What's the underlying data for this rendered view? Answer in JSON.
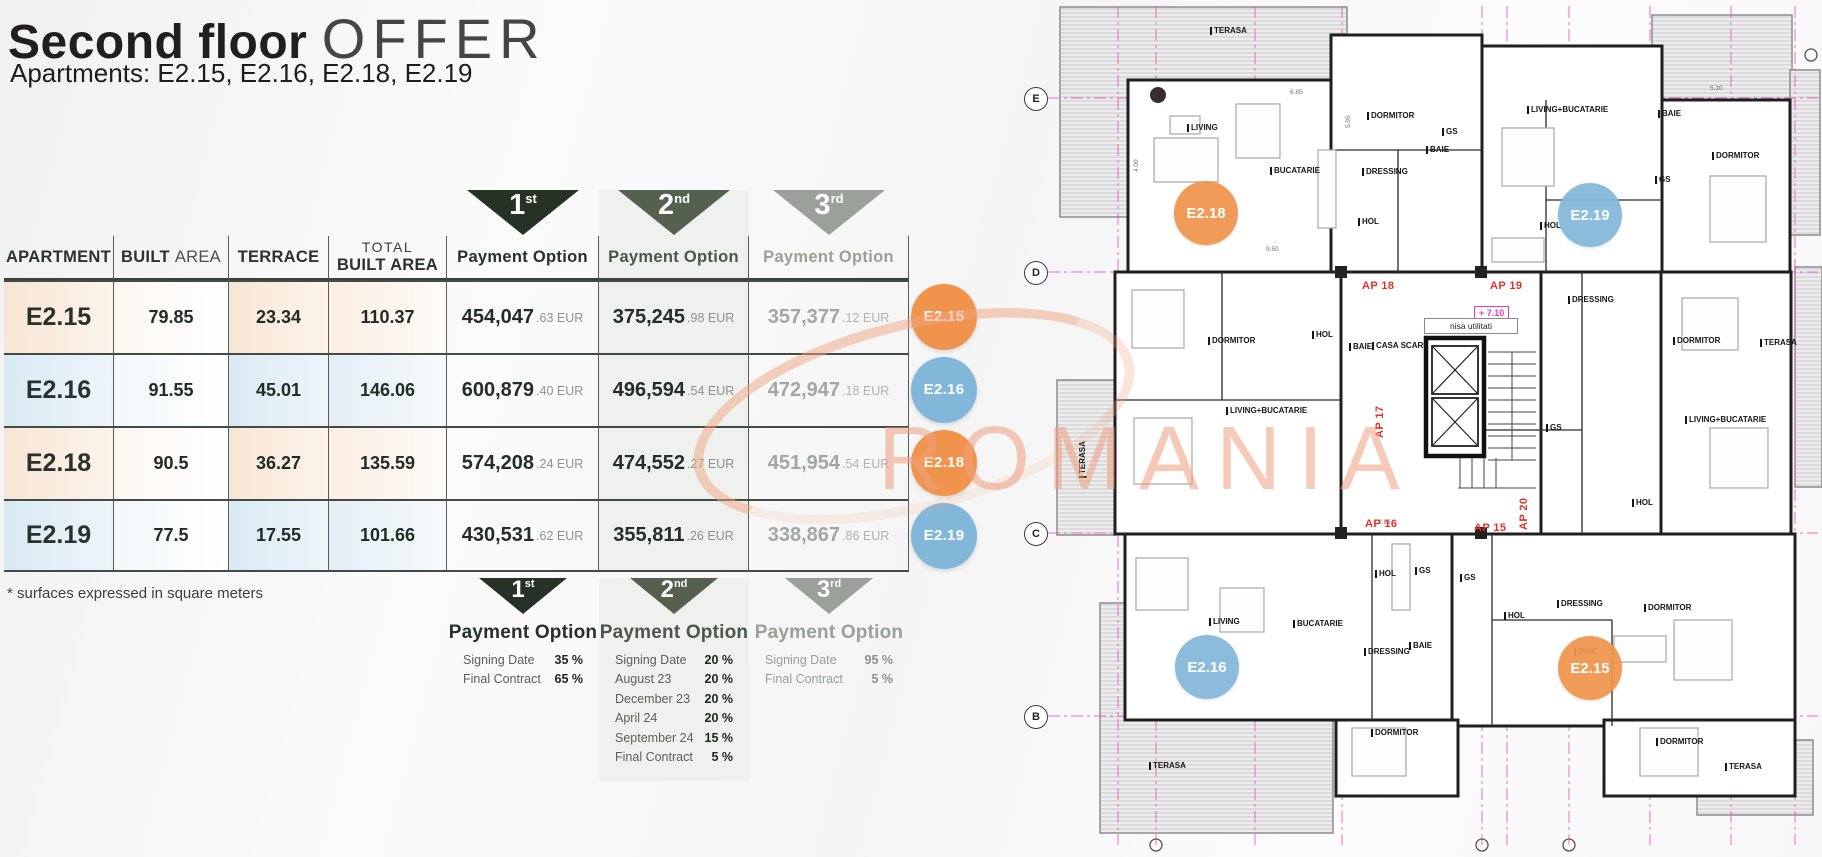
{
  "header": {
    "title_bold": "Second floor",
    "title_light": "OFFER",
    "subtitle": "Apartments: E2.15, E2.16, E2.18, E2.19"
  },
  "table": {
    "columns": {
      "apartment": "APARTMENT",
      "built_bold": "BUILT",
      "built_light": "AREA",
      "terrace": "TERRACE",
      "total_line1": "TOTAL",
      "total_line2": "BUILT AREA",
      "payment": "Payment Option"
    },
    "options": [
      {
        "ord": "1",
        "sup": "st"
      },
      {
        "ord": "2",
        "sup": "nd"
      },
      {
        "ord": "3",
        "sup": "rd"
      }
    ],
    "rows": [
      {
        "apartment": "E2.15",
        "built": "79.85",
        "terrace": "23.34",
        "total": "110.37",
        "p1_main": "454,047",
        "p1_cents": ".63 EUR",
        "p2_main": "375,245",
        "p2_cents": ".98 EUR",
        "p3_main": "357,377",
        "p3_cents": ".12 EUR",
        "badge": "E2.15",
        "tint": "orange"
      },
      {
        "apartment": "E2.16",
        "built": "91.55",
        "terrace": "45.01",
        "total": "146.06",
        "p1_main": "600,879",
        "p1_cents": ".40 EUR",
        "p2_main": "496,594",
        "p2_cents": ".54 EUR",
        "p3_main": "472,947",
        "p3_cents": ".18 EUR",
        "badge": "E2.16",
        "tint": "blue"
      },
      {
        "apartment": "E2.18",
        "built": "90.5",
        "terrace": "36.27",
        "total": "135.59",
        "p1_main": "574,208",
        "p1_cents": ".24 EUR",
        "p2_main": "474,552",
        "p2_cents": ".27 EUR",
        "p3_main": "451,954",
        "p3_cents": ".54 EUR",
        "badge": "E2.18",
        "tint": "orange"
      },
      {
        "apartment": "E2.19",
        "built": "77.5",
        "terrace": "17.55",
        "total": "101.66",
        "p1_main": "430,531",
        "p1_cents": ".62 EUR",
        "p2_main": "355,811",
        "p2_cents": ".26 EUR",
        "p3_main": "338,867",
        "p3_cents": ".86 EUR",
        "badge": "E2.19",
        "tint": "blue"
      }
    ]
  },
  "footnote": "* surfaces expressed in square meters",
  "schedules": [
    {
      "rows": [
        [
          "Signing Date",
          "35 %"
        ],
        [
          "Final Contract",
          "65 %"
        ]
      ]
    },
    {
      "rows": [
        [
          "Signing Date",
          "20 %"
        ],
        [
          "August 23",
          "20 %"
        ],
        [
          "December 23",
          "20 %"
        ],
        [
          "April 24",
          "20 %"
        ],
        [
          "September 24",
          "15 %"
        ],
        [
          "Final Contract",
          "5 %"
        ]
      ]
    },
    {
      "rows": [
        [
          "Signing Date",
          "95 %"
        ],
        [
          "Final Contract",
          "5 %"
        ]
      ]
    }
  ],
  "watermark": "ROMANIA",
  "colors": {
    "accent_orange": "#f0944d",
    "accent_blue": "#83b7da",
    "triangle_1": "#273226",
    "triangle_2": "#56604f",
    "triangle_3": "#9ba19a",
    "grid_pink": "#ee4fc4",
    "ap_red": "#e2312a"
  },
  "floorplan": {
    "grid_rows": [
      {
        "letter": "E",
        "y": 98
      },
      {
        "letter": "D",
        "y": 272
      },
      {
        "letter": "C",
        "y": 533
      },
      {
        "letter": "B",
        "y": 716
      }
    ],
    "badges": [
      {
        "label": "E2.18",
        "color": "orange",
        "x": 184,
        "y": 213
      },
      {
        "label": "E2.19",
        "color": "blue",
        "x": 568,
        "y": 215
      },
      {
        "label": "E2.16",
        "color": "blue",
        "x": 185,
        "y": 667
      },
      {
        "label": "E2.15",
        "color": "orange",
        "x": 568,
        "y": 668
      }
    ],
    "ap_labels": [
      {
        "text": "AP 18",
        "x": 340,
        "y": 280
      },
      {
        "text": "AP 19",
        "x": 468,
        "y": 280
      },
      {
        "text": "AP 17",
        "x": 352,
        "y": 438,
        "rot": -90
      },
      {
        "text": "AP 16",
        "x": 343,
        "y": 518
      },
      {
        "text": "AP 15",
        "x": 452,
        "y": 522
      },
      {
        "text": "AP 20",
        "x": 496,
        "y": 530,
        "rot": -90
      }
    ],
    "level_label": "+ 7.10",
    "nisa_label": "nisa utilitati",
    "room_labels": [
      {
        "text": "TERASA",
        "x": 188,
        "y": 27
      },
      {
        "text": "LIVING",
        "x": 165,
        "y": 124
      },
      {
        "text": "BUCATARIE",
        "x": 248,
        "y": 167
      },
      {
        "text": "DORMITOR",
        "x": 345,
        "y": 112
      },
      {
        "text": "DRESSING",
        "x": 340,
        "y": 168
      },
      {
        "text": "BAIE",
        "x": 404,
        "y": 146
      },
      {
        "text": "GS",
        "x": 420,
        "y": 128
      },
      {
        "text": "HOL",
        "x": 336,
        "y": 218
      },
      {
        "text": "LIVING+BUCATARIE",
        "x": 505,
        "y": 106
      },
      {
        "text": "BAIE",
        "x": 636,
        "y": 110
      },
      {
        "text": "DORMITOR",
        "x": 690,
        "y": 152
      },
      {
        "text": "GS",
        "x": 633,
        "y": 176
      },
      {
        "text": "HOL",
        "x": 518,
        "y": 222
      },
      {
        "text": "DORMITOR",
        "x": 186,
        "y": 337
      },
      {
        "text": "HOL",
        "x": 290,
        "y": 331
      },
      {
        "text": "BAIE",
        "x": 327,
        "y": 343
      },
      {
        "text": "CASA SCARII",
        "x": 350,
        "y": 342
      },
      {
        "text": "LIVING+BUCATARIE",
        "x": 204,
        "y": 407
      },
      {
        "text": "DRESSING",
        "x": 546,
        "y": 296
      },
      {
        "text": "DORMITOR",
        "x": 651,
        "y": 337
      },
      {
        "text": "TERASA",
        "x": 738,
        "y": 339
      },
      {
        "text": "LIVING+BUCATARIE",
        "x": 663,
        "y": 416
      },
      {
        "text": "GS",
        "x": 524,
        "y": 424
      },
      {
        "text": "HOL",
        "x": 610,
        "y": 499
      },
      {
        "text": "TERASA",
        "x": 57,
        "y": 478,
        "rot": -90
      },
      {
        "text": "LIVING",
        "x": 187,
        "y": 618
      },
      {
        "text": "BUCATARIE",
        "x": 271,
        "y": 620
      },
      {
        "text": "HOL",
        "x": 353,
        "y": 570
      },
      {
        "text": "GS",
        "x": 393,
        "y": 567
      },
      {
        "text": "GS",
        "x": 438,
        "y": 574
      },
      {
        "text": "DRESSING",
        "x": 342,
        "y": 648
      },
      {
        "text": "BAIE",
        "x": 387,
        "y": 642
      },
      {
        "text": "DRESSING",
        "x": 535,
        "y": 600
      },
      {
        "text": "HOL",
        "x": 482,
        "y": 612
      },
      {
        "text": "DORMITOR",
        "x": 622,
        "y": 604
      },
      {
        "text": "BAIE",
        "x": 552,
        "y": 648
      },
      {
        "text": "DORMITOR",
        "x": 349,
        "y": 729
      },
      {
        "text": "TERASA",
        "x": 127,
        "y": 762
      },
      {
        "text": "DORMITOR",
        "x": 634,
        "y": 738
      },
      {
        "text": "TERASA",
        "x": 703,
        "y": 763
      }
    ],
    "dim_labels": [
      {
        "text": "6.85",
        "x": 268,
        "y": 90
      },
      {
        "text": "4.00",
        "x": 112,
        "y": 172,
        "rot": -90
      },
      {
        "text": "5.10",
        "x": 688,
        "y": 86
      },
      {
        "text": "9.50",
        "x": 244,
        "y": 247
      },
      {
        "text": "5.95",
        "x": 324,
        "y": 128,
        "rot": -90
      },
      {
        "text": "2.86",
        "x": 356,
        "y": 520
      }
    ]
  }
}
